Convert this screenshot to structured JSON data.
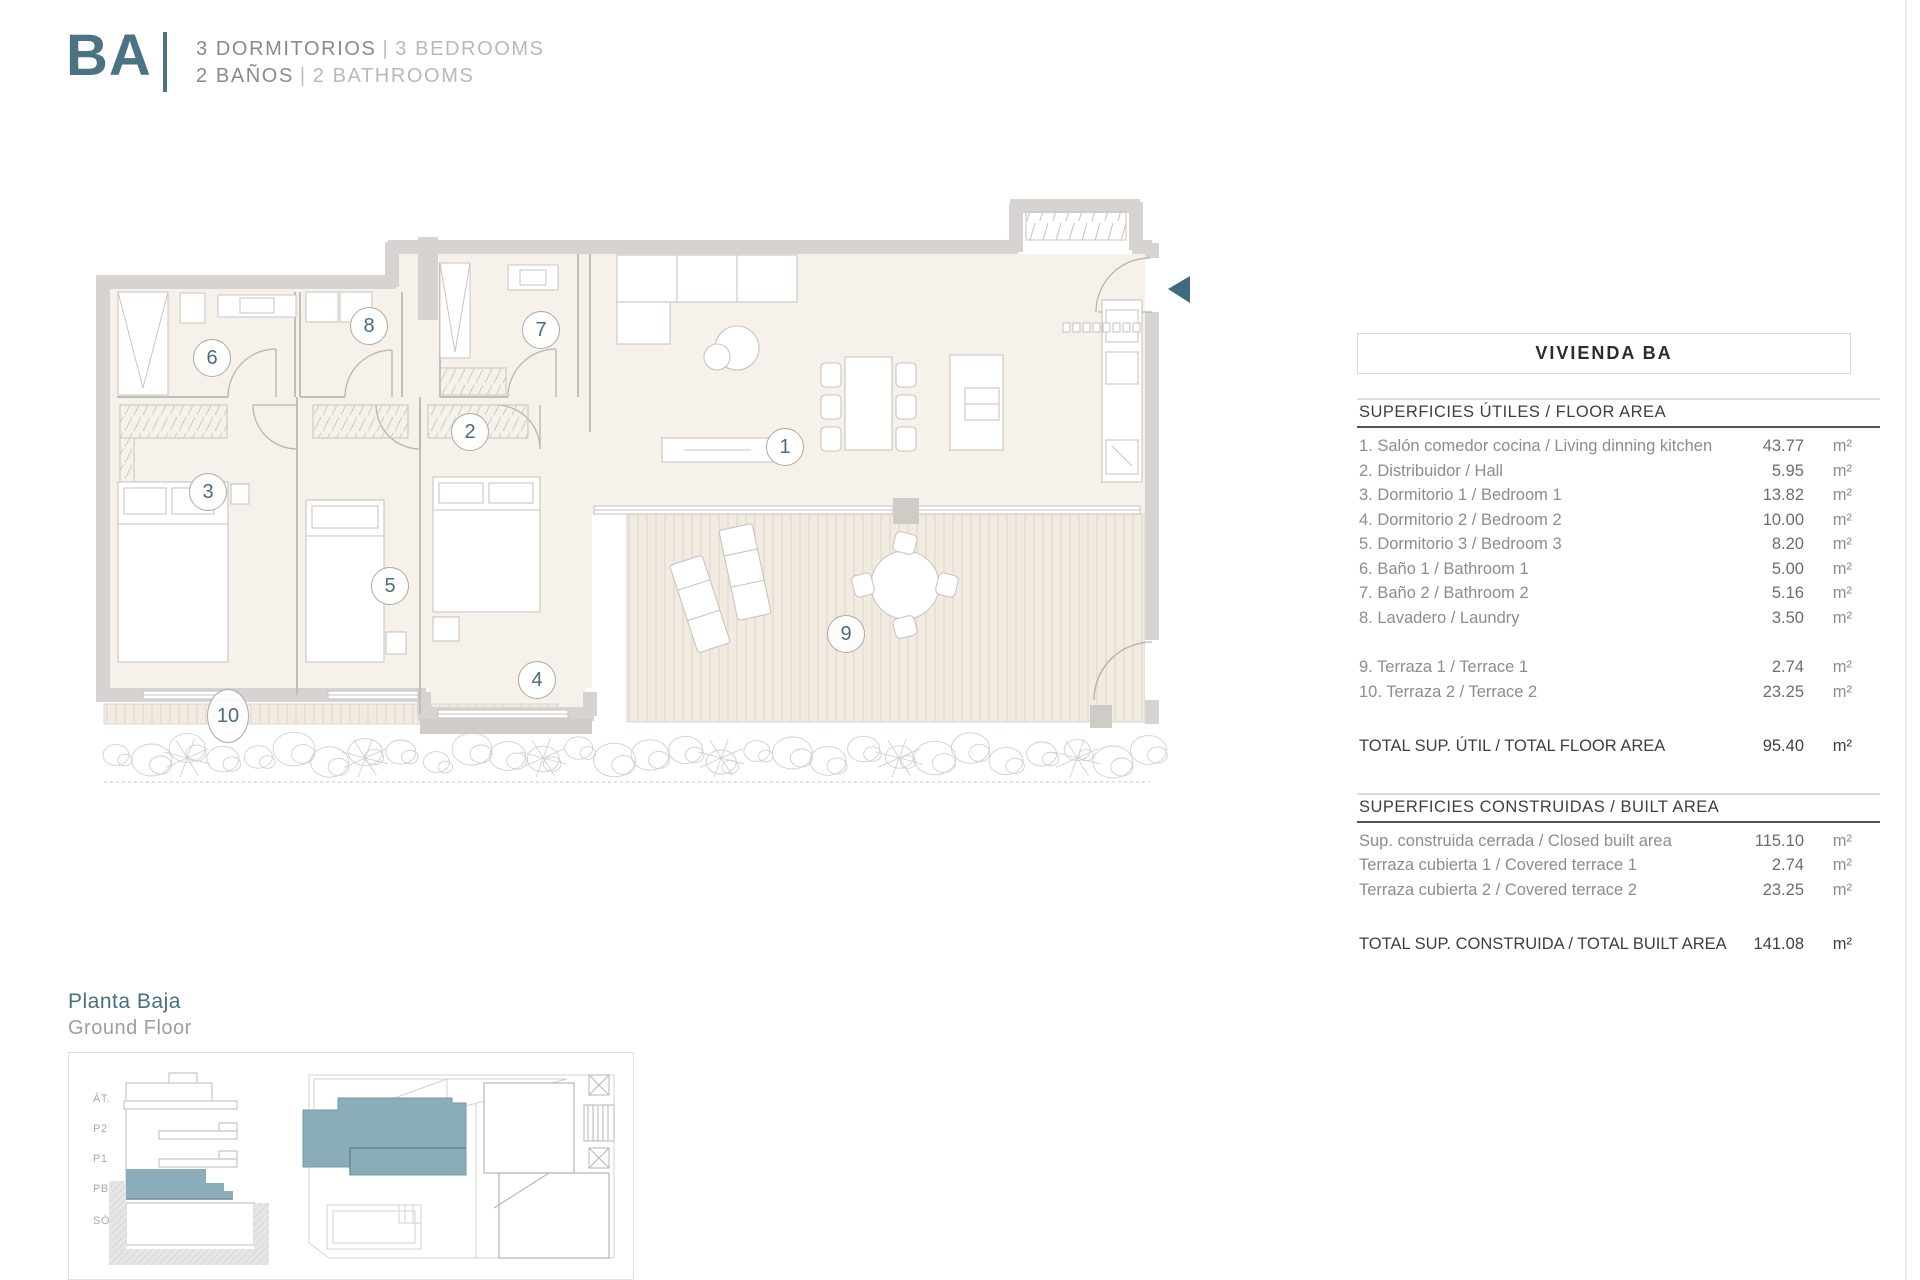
{
  "header": {
    "code": "BA",
    "line1": {
      "primary": "3 DORMITORIOS",
      "separator": "|",
      "secondary": "3 BEDROOMS"
    },
    "line2": {
      "primary": "2 BAÑOS",
      "separator": "|",
      "secondary": "2 BATHROOMS"
    }
  },
  "panel": {
    "title": "VIVIENDA BA",
    "sections": [
      {
        "heading": "SUPERFICIES ÚTILES / FLOOR AREA",
        "groups": [
          [
            {
              "label": "1. Salón comedor cocina / Living dinning kitchen",
              "value": "43.77",
              "unit": "m²"
            },
            {
              "label": "2. Distribuidor / Hall",
              "value": "5.95",
              "unit": "m²"
            },
            {
              "label": "3. Dormitorio 1 / Bedroom 1",
              "value": "13.82",
              "unit": "m²"
            },
            {
              "label": "4. Dormitorio 2 / Bedroom 2",
              "value": "10.00",
              "unit": "m²"
            },
            {
              "label": "5. Dormitorio 3 / Bedroom 3",
              "value": "8.20",
              "unit": "m²"
            },
            {
              "label": "6. Baño 1 / Bathroom 1",
              "value": "5.00",
              "unit": "m²"
            },
            {
              "label": "7. Baño 2 / Bathroom 2",
              "value": "5.16",
              "unit": "m²"
            },
            {
              "label": "8. Lavadero / Laundry",
              "value": "3.50",
              "unit": "m²"
            }
          ],
          [
            {
              "label": "9. Terraza 1 / Terrace 1",
              "value": "2.74",
              "unit": "m²"
            },
            {
              "label": "10. Terraza 2 / Terrace 2",
              "value": "23.25",
              "unit": "m²"
            }
          ]
        ],
        "total": {
          "label": "TOTAL SUP. ÚTIL / TOTAL FLOOR AREA",
          "value": "95.40",
          "unit": "m²"
        }
      },
      {
        "heading": "SUPERFICIES CONSTRUIDAS / BUILT AREA",
        "groups": [
          [
            {
              "label": "Sup. construida cerrada / Closed built area",
              "value": "115.10",
              "unit": "m²"
            },
            {
              "label": "Terraza cubierta 1 / Covered terrace 1",
              "value": "2.74",
              "unit": "m²"
            },
            {
              "label": "Terraza cubierta 2 / Covered terrace 2",
              "value": "23.25",
              "unit": "m²"
            }
          ]
        ],
        "total": {
          "label": "TOTAL SUP. CONSTRUIDA / TOTAL BUILT AREA",
          "value": "141.08",
          "unit": "m²"
        }
      }
    ]
  },
  "floorplan": {
    "room_markers": [
      {
        "n": "1",
        "x": 785,
        "y": 447
      },
      {
        "n": "2",
        "x": 470,
        "y": 432
      },
      {
        "n": "3",
        "x": 208,
        "y": 492
      },
      {
        "n": "4",
        "x": 537,
        "y": 680
      },
      {
        "n": "5",
        "x": 390,
        "y": 586
      },
      {
        "n": "6",
        "x": 212,
        "y": 358
      },
      {
        "n": "7",
        "x": 541,
        "y": 330
      },
      {
        "n": "8",
        "x": 369,
        "y": 326
      },
      {
        "n": "9",
        "x": 846,
        "y": 634
      },
      {
        "n": "10",
        "x": 228,
        "y": 716
      }
    ],
    "entry_marker": "entry-arrow"
  },
  "legend": {
    "title_primary": "Planta Baja",
    "title_secondary": "Ground Floor",
    "floor_labels": [
      "ÁT.",
      "P2",
      "P1",
      "PB",
      "SÓT."
    ]
  },
  "colors": {
    "accent": "#4b7383",
    "accent_fill": "#8badba",
    "wall": "#d6d3d0",
    "room_fill": "#f6f1ea",
    "terrace_fill": "#f2ebe2"
  }
}
